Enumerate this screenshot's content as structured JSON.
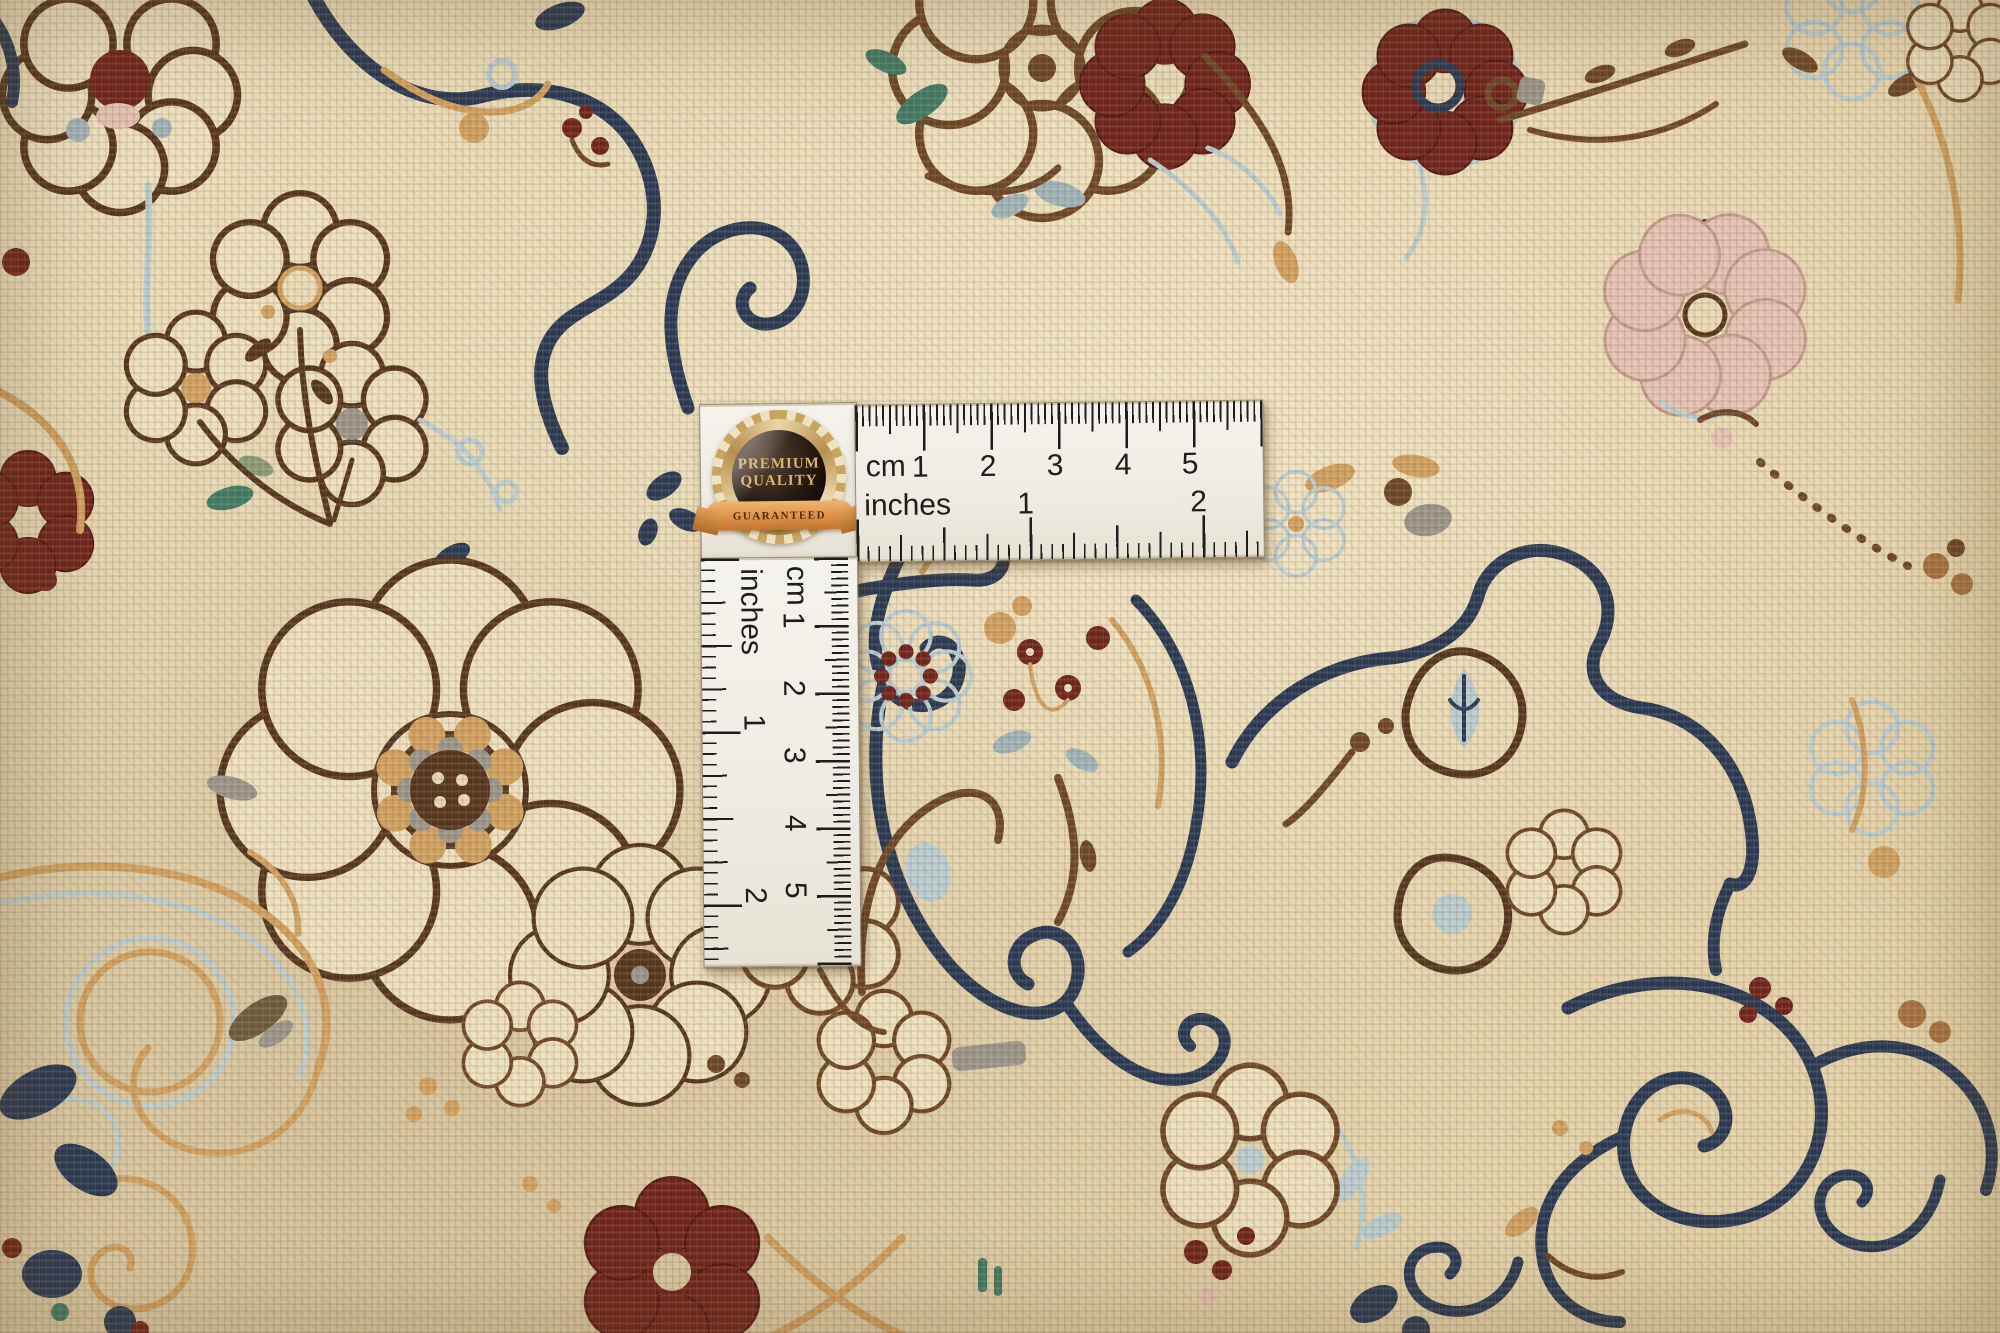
{
  "badge": {
    "line1": "PREMIUM",
    "line2": "QUALITY",
    "ribbon": "GUARANTEED"
  },
  "rulers": {
    "horizontal": {
      "cm_label": "cm",
      "cm_numbers": [
        "1",
        "2",
        "3",
        "4",
        "5"
      ],
      "inch_label": "inches",
      "inch_numbers": [
        "1",
        "2"
      ]
    },
    "vertical": {
      "cm_label": "cm",
      "cm_numbers": [
        "1",
        "2",
        "3",
        "4",
        "5"
      ],
      "inch_label": "inches",
      "inch_numbers": [
        "1",
        "2"
      ]
    }
  },
  "rug": {
    "palette": {
      "base": "#e9d9b2",
      "cream": "#eee1bf",
      "navy": "#263652",
      "dark_brown": "#53331b",
      "brown": "#6b4423",
      "tan": "#d2a05f",
      "light_blue": "#bacdd2",
      "gray_blue": "#9fb4ba",
      "maroon": "#6e2019",
      "pink": "#e6c2b5",
      "teal": "#3f7a63",
      "gray": "#9a958a"
    }
  }
}
